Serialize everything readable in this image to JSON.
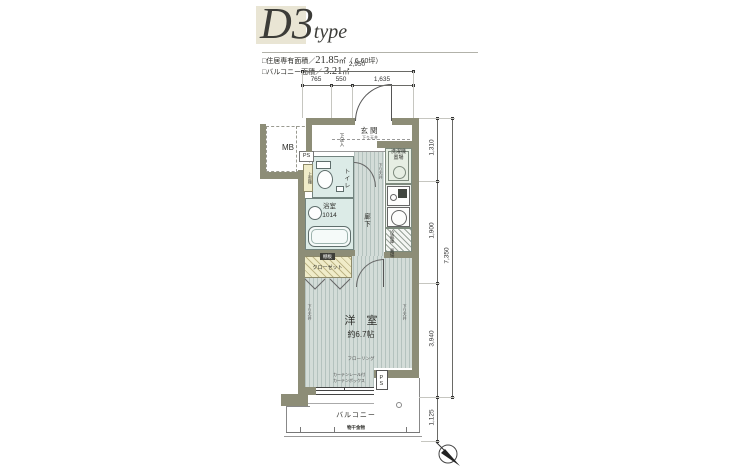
{
  "colors": {
    "wall": "#8d8d77",
    "floor_base": "#d3dcd8",
    "floor_stripe": "#b4c2be",
    "wet": "#dcebe7",
    "cream": "#f0ecc9",
    "kitchen": "#e6eee3",
    "title_bg": "#e9e5d4",
    "text": "#2e2e2a"
  },
  "title": {
    "main": "D3",
    "suffix": "type"
  },
  "areas": [
    {
      "label": "□住居専有面積／",
      "value": "21.85",
      "unit": "㎡",
      "extra": "（ 6.60坪）"
    },
    {
      "label": "□バルコニー面積／ ",
      "value": "3.21",
      "unit": "㎡",
      "extra": ""
    }
  ],
  "dimensions": {
    "top_total": "2,950",
    "top_segments": [
      "765",
      "550",
      "1,635"
    ],
    "right": [
      "1,310",
      "1,900",
      "3,940",
      "1,125"
    ],
    "right_total": "7,350"
  },
  "rooms": {
    "meter_box": "MB",
    "pipe_space": "PS",
    "shoe_box": "下足入",
    "entrance": "玄関",
    "entrance_note": "下り天井",
    "toilet": "トイレ",
    "upper_shelf": "上部棚",
    "bath": "浴室",
    "bath_size": "1014",
    "hall": "廊下",
    "washer_l1": "洗濯機",
    "washer_l2": "置場",
    "fridge_l1": "冷蔵庫",
    "fridge_l2": "置場",
    "closet": "クローゼット",
    "closet_shelf": "棚板",
    "room": "洋　室",
    "room_size": "約6.7帖",
    "flooring": "フローリング",
    "ceiling_note": "下り天井",
    "curtain_l1": "カーテンレール付",
    "curtain_l2": "カーテンボックス",
    "balcony": "バルコニー",
    "balcony_note": "物干金物",
    "ps_bottom": "PS"
  }
}
